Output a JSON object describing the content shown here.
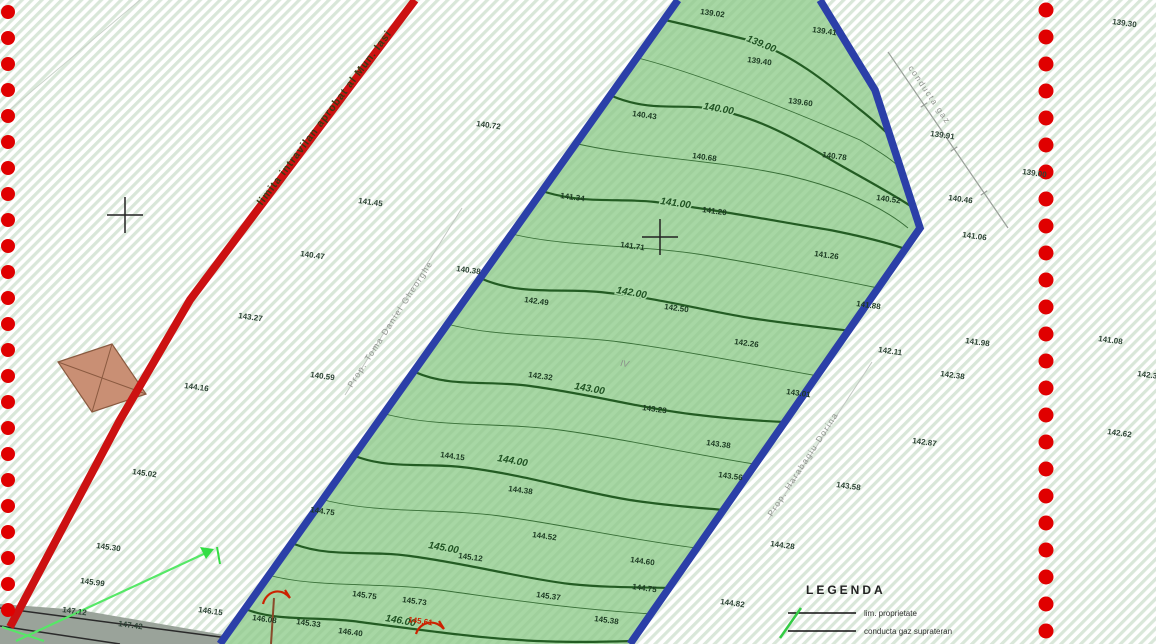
{
  "map": {
    "kind": "cadastral topographic plan",
    "colors": {
      "parcel_fill": "#a7d7a4",
      "parcel_boundary": "#2b3fa8",
      "contour": "#235c23",
      "intravilan_line": "#cc1111",
      "boundary_dot": "#e00000",
      "hatch": "#d9e7d9",
      "building_fill": "#c98f74",
      "arrow_green": "#55e866",
      "road_gray": "#9aa39a"
    }
  },
  "red_line": {
    "label": "limita intravilan aprobat al Mun. Iasi"
  },
  "annotations": {
    "owner_left": "Prop. Toma Daniel Gheorghe",
    "owner_right": "Prop. Harabagiu Dorina",
    "pipeline": "conducta gaz",
    "parcel_note": "IV"
  },
  "legend": {
    "title": "LEGENDA",
    "items": [
      {
        "symbol": "black-line",
        "label": "lim. proprietate"
      },
      {
        "symbol": "black-line-green-arrow",
        "label": "conducta gaz suprateran"
      }
    ]
  },
  "contours": [
    {
      "label": "139.00",
      "lx": 746,
      "ly": 41,
      "angle": 22,
      "d": "M665,20 C700,28 724,34 748,40 C790,52 830,85 858,108 C872,119 882,128 890,136"
    },
    {
      "label": "140.00",
      "lx": 703,
      "ly": 109,
      "angle": 10,
      "d": "M612,96 C650,112 680,104 706,108 C760,116 800,142 840,165 C870,182 896,196 912,207"
    },
    {
      "label": "141.00",
      "lx": 660,
      "ly": 204,
      "angle": 8,
      "d": "M545,192 C585,204 620,198 655,202 C720,210 780,222 830,230 C860,236 886,242 905,249"
    },
    {
      "label": "142.00",
      "lx": 616,
      "ly": 293,
      "angle": 10,
      "d": "M480,278 C520,296 560,288 600,292 C660,298 700,310 750,318 C790,324 826,328 852,331"
    },
    {
      "label": "143.00",
      "lx": 574,
      "ly": 389,
      "angle": 10,
      "d": "M415,372 C450,388 490,380 530,386 C590,394 640,408 690,414 C730,419 762,421 784,422"
    },
    {
      "label": "144.00",
      "lx": 497,
      "ly": 461,
      "angle": 10,
      "d": "M355,456 C390,470 430,462 470,468 C530,476 580,492 630,500 C670,506 702,508 724,510"
    },
    {
      "label": "145.00",
      "lx": 428,
      "ly": 548,
      "angle": 10,
      "d": "M294,544 C330,558 370,550 410,556 C470,564 520,578 570,584 C610,588 642,587 670,588"
    },
    {
      "label": "146.00",
      "lx": 385,
      "ly": 621,
      "angle": 10,
      "d": "M248,610 C280,622 320,616 360,622 C420,630 480,638 520,640 C560,643 602,642 634,641"
    }
  ],
  "intermediate_contours": [
    "M638,58 C700,74 790,110 860,140 C885,155 900,165 902,172",
    "M578,144 C640,158 720,160 790,176 C840,188 880,205 908,228",
    "M512,234 C570,248 640,244 710,256 C770,266 820,276 878,288",
    "M447,324 C500,338 560,334 620,342 C680,350 740,362 818,376",
    "M385,414 C440,428 500,422 560,430 C620,438 680,452 754,464",
    "M324,500 C380,514 440,508 500,516 C560,524 620,538 696,548",
    "M272,576 C320,588 380,582 440,590 C500,598 560,608 652,614"
  ],
  "spot_heights": {
    "parcel": [
      [
        700,
        14,
        "139.02"
      ],
      [
        747,
        62,
        "139.40"
      ],
      [
        812,
        32,
        "139.41"
      ],
      [
        788,
        103,
        "139.60"
      ],
      [
        632,
        116,
        "140.43"
      ],
      [
        692,
        158,
        "140.68"
      ],
      [
        822,
        157,
        "140.78"
      ],
      [
        876,
        200,
        "140.52"
      ],
      [
        560,
        198,
        "141.34"
      ],
      [
        702,
        212,
        "141.20"
      ],
      [
        620,
        247,
        "141.71"
      ],
      [
        814,
        256,
        "141.26"
      ],
      [
        856,
        306,
        "141.88"
      ],
      [
        524,
        302,
        "142.49"
      ],
      [
        664,
        309,
        "142.50"
      ],
      [
        734,
        344,
        "142.26"
      ],
      [
        528,
        377,
        "142.32"
      ],
      [
        786,
        394,
        "143.01"
      ],
      [
        642,
        410,
        "143.23"
      ],
      [
        706,
        445,
        "143.38"
      ],
      [
        718,
        477,
        "143.56"
      ],
      [
        440,
        457,
        "144.15"
      ],
      [
        508,
        491,
        "144.38"
      ],
      [
        532,
        537,
        "144.52"
      ],
      [
        310,
        512,
        "144.75"
      ],
      [
        458,
        558,
        "145.12"
      ],
      [
        630,
        562,
        "144.60"
      ],
      [
        632,
        589,
        "144.75"
      ],
      [
        536,
        597,
        "145.37"
      ],
      [
        594,
        621,
        "145.38"
      ],
      [
        352,
        596,
        "145.75"
      ],
      [
        402,
        602,
        "145.73"
      ],
      [
        252,
        620,
        "146.08"
      ],
      [
        296,
        624,
        "145.33"
      ],
      [
        338,
        633,
        "146.40"
      ]
    ],
    "left": [
      [
        476,
        126,
        "140.72"
      ],
      [
        358,
        203,
        "141.45"
      ],
      [
        300,
        256,
        "140.47"
      ],
      [
        238,
        318,
        "143.27"
      ],
      [
        456,
        271,
        "140.38"
      ],
      [
        310,
        377,
        "140.59"
      ],
      [
        184,
        388,
        "144.16"
      ],
      [
        132,
        474,
        "145.02"
      ],
      [
        96,
        548,
        "145.30"
      ],
      [
        80,
        583,
        "145.99"
      ],
      [
        198,
        612,
        "146.15"
      ],
      [
        62,
        612,
        "147.12"
      ],
      [
        118,
        626,
        "147.42"
      ]
    ],
    "right": [
      [
        1112,
        24,
        "139.30"
      ],
      [
        930,
        136,
        "139.91"
      ],
      [
        1022,
        174,
        "139.00"
      ],
      [
        948,
        200,
        "140.46"
      ],
      [
        962,
        237,
        "141.06"
      ],
      [
        965,
        343,
        "141.98"
      ],
      [
        878,
        352,
        "142.11"
      ],
      [
        940,
        376,
        "142.38"
      ],
      [
        912,
        443,
        "142.87"
      ],
      [
        836,
        487,
        "143.58"
      ],
      [
        770,
        546,
        "144.28"
      ],
      [
        720,
        604,
        "144.82"
      ],
      [
        1098,
        341,
        "141.08"
      ],
      [
        1137,
        376,
        "142.35"
      ],
      [
        1107,
        434,
        "142.62"
      ]
    ],
    "red_point": [
      408,
      622,
      "145.61"
    ]
  },
  "crosses": [
    {
      "x": 125,
      "y": 215
    },
    {
      "x": 660,
      "y": 237
    }
  ],
  "dot_columns": [
    {
      "x": 8,
      "y0": 12,
      "step": 26,
      "count": 24,
      "r": 7
    },
    {
      "x": 1046,
      "y0": 10,
      "step": 27,
      "count": 24,
      "r": 7.5
    }
  ]
}
